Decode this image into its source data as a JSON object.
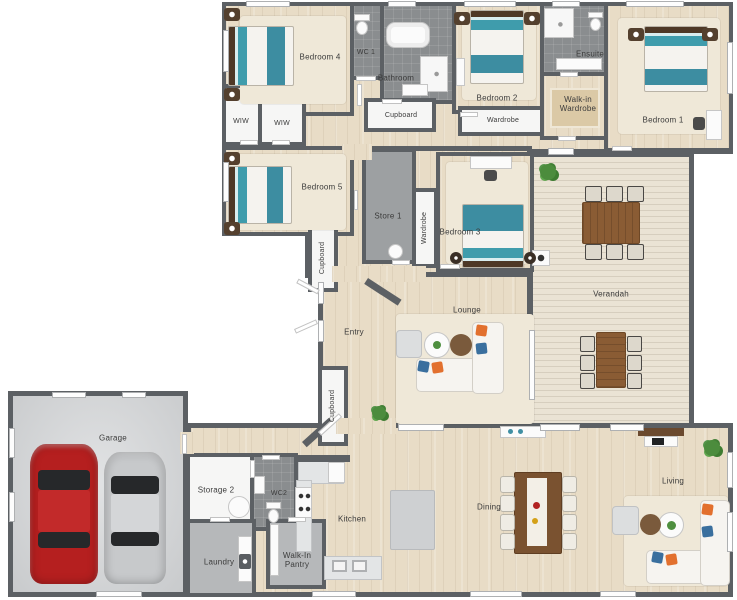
{
  "plan": {
    "rooms": {
      "bedroom4": {
        "label": "Bedroom 4"
      },
      "wc1": {
        "label": "WC 1"
      },
      "bathroom": {
        "label": "Bathroom"
      },
      "cupboard1": {
        "label": "Cupboard"
      },
      "bedroom2": {
        "label": "Bedroom 2"
      },
      "wardrobe1": {
        "label": "Wardrobe"
      },
      "ensuite": {
        "label": "Ensuite"
      },
      "walkin_wardrobe": {
        "label": "Walk-in Wardrobe"
      },
      "bedroom1": {
        "label": "Bedroom 1"
      },
      "wiw1": {
        "label": "WIW"
      },
      "wiw2": {
        "label": "WIW"
      },
      "bedroom5": {
        "label": "Bedroom 5"
      },
      "cupboard2": {
        "label": "Cupboard"
      },
      "store1": {
        "label": "Store 1"
      },
      "wardrobe2": {
        "label": "Wardrobe"
      },
      "bedroom3": {
        "label": "Bedroom 3"
      },
      "entry": {
        "label": "Entry"
      },
      "lounge": {
        "label": "Lounge"
      },
      "verandah": {
        "label": "Verandah"
      },
      "cupboard3": {
        "label": "Cupboard"
      },
      "garage": {
        "label": "Garage"
      },
      "storage2": {
        "label": "Storage 2"
      },
      "wc2": {
        "label": "WC2"
      },
      "laundry": {
        "label": "Laundry"
      },
      "walkin_pantry": {
        "label": "Walk-In Pantry"
      },
      "kitchen": {
        "label": "Kitchen"
      },
      "dining": {
        "label": "Dining"
      },
      "living": {
        "label": "Living"
      }
    },
    "palette": {
      "wall": "#5c6064",
      "wood_floor": "#e8dcc6",
      "deck_floor": "#eae3d4",
      "tile_floor": "#8a8d8f",
      "garage_floor": "#d5d7d9",
      "car_red": "#b51f1f",
      "car_silver": "#c7c9cb",
      "bed_teal": "#3f9cac",
      "pillow_orange": "#e2702e",
      "pillow_blue": "#3a6f9e",
      "table_brown": "#8a5c34"
    }
  }
}
